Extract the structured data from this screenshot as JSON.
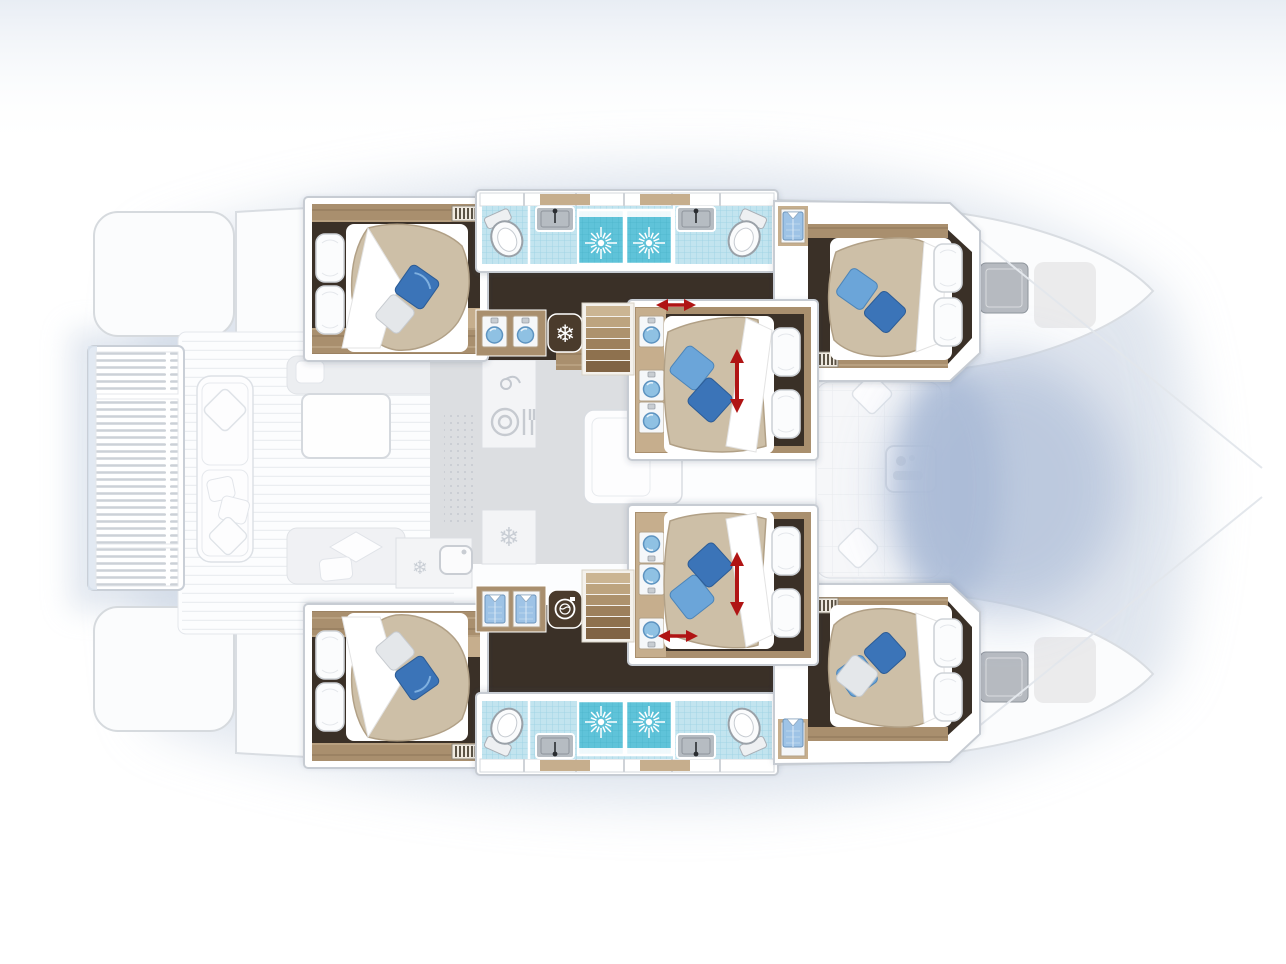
{
  "meta": {
    "kind": "yacht-floor-plan",
    "view": "top-down",
    "vessel": "catamaran",
    "label": "Catamaran six-cabin lower deck floor plan with ghosted main deck",
    "focus": "lower-deck cabins rendered in full color, main deck ghosted"
  },
  "colors": {
    "floor": "#3a3027",
    "floor2": "#4a3d31",
    "wood": "#a98f6e",
    "woodL": "#c6ae8d",
    "woodD": "#7d6547",
    "tile": "#c2e4ef",
    "tileG": "#9ad2e4",
    "shower": "#5fc3d9",
    "showerG": "#4cb5cc",
    "duvet": "#cdbfa7",
    "duvetE": "#b1a086",
    "pBlue": "#3b74b8",
    "pBlueL": "#6ba5d9",
    "pGray": "#e4e7ea",
    "arrow": "#b01414",
    "darkTile": "#4a3b2c",
    "ghostF": "#f8f9fb",
    "ghostS": "#d7dbe1",
    "saloon": "#dcdee1",
    "hatch": "#b6bac0",
    "shadow": "#c6d1e1",
    "net": "#b7c5dc"
  },
  "port_hull": {
    "aft_cabin": {
      "bed": "island-double",
      "white_pillows": 2,
      "throw_pillows": [
        "blue",
        "white"
      ],
      "vent_grille": true
    },
    "aft_bathroom": {
      "fixtures": [
        "toilet",
        "washbasin",
        "shower-with-drain-rose"
      ]
    },
    "fwd_bathroom": {
      "fixtures": [
        "toilet",
        "washbasin",
        "shower-with-drain-rose"
      ]
    },
    "forward_cabin": {
      "bed": "island-double",
      "white_pillows": 2,
      "throw_pillows": [
        "light-blue",
        "blue"
      ],
      "wardrobe_shirts": 1,
      "vent_grille": true
    },
    "companionway": {
      "features": [
        "twin-washbasin-vanity",
        "freezer-snowflake",
        "staircase"
      ],
      "sliding_door_arrow": true
    }
  },
  "starboard_hull": {
    "aft_cabin": {
      "bed": "island-double",
      "white_pillows": 2,
      "throw_pillows": [
        "white",
        "blue"
      ],
      "vent_grille": true
    },
    "aft_bathroom": {
      "fixtures": [
        "toilet",
        "washbasin",
        "shower-with-drain-rose"
      ]
    },
    "fwd_bathroom": {
      "fixtures": [
        "toilet",
        "washbasin",
        "shower-with-drain-rose"
      ]
    },
    "forward_cabin": {
      "bed": "island-double",
      "white_pillows": 2,
      "throw_pillows": [
        "blue",
        "white"
      ],
      "wardrobe_shirts": 1,
      "vent_grille": true
    },
    "companionway": {
      "features": [
        "wardrobe-two-shirts",
        "washing-machine",
        "staircase"
      ],
      "sliding_door_arrow": true
    }
  },
  "center_nacelle": {
    "cabin_port_side": {
      "bed": "double",
      "adjustable_bed_arrow": true,
      "washbasins": 3
    },
    "cabin_starboard_side": {
      "bed": "double",
      "adjustable_bed_arrow": true,
      "washbasins": 3
    }
  },
  "ghosted_main_deck": {
    "aft_area": [
      "stern-platform-port",
      "stern-platform-starboard",
      "slatted-swim-platform"
    ],
    "cockpit": [
      "l-sofa-with-cushions",
      "coffee-table",
      "bench-with-chevron-cushion",
      "sofa"
    ],
    "saloon": [
      "galley-counter",
      "faucet",
      "dining-plate-cutlery",
      "fridge-snowflake",
      "sink",
      "dotted-mat",
      "sofa"
    ],
    "forward_cockpit": [
      "seating-with-cushions",
      "table"
    ],
    "bow": [
      "deck-hatch-port",
      "deck-hatch-starboard",
      "trampoline-area",
      "rigging-lines"
    ]
  },
  "indicators": {
    "bed_adjust_arrows": 2,
    "sliding_door_arrows": 2,
    "arrow_color": "#b01414"
  },
  "icon_names": [
    "snowflake-icon",
    "washing-machine-icon",
    "shirt-icon",
    "shower-drain-icon",
    "toilet-icon",
    "washbasin-icon",
    "sink-icon",
    "vent-grille-icon",
    "plate-cutlery-icon",
    "faucet-icon",
    "adjust-arrow-icon"
  ]
}
